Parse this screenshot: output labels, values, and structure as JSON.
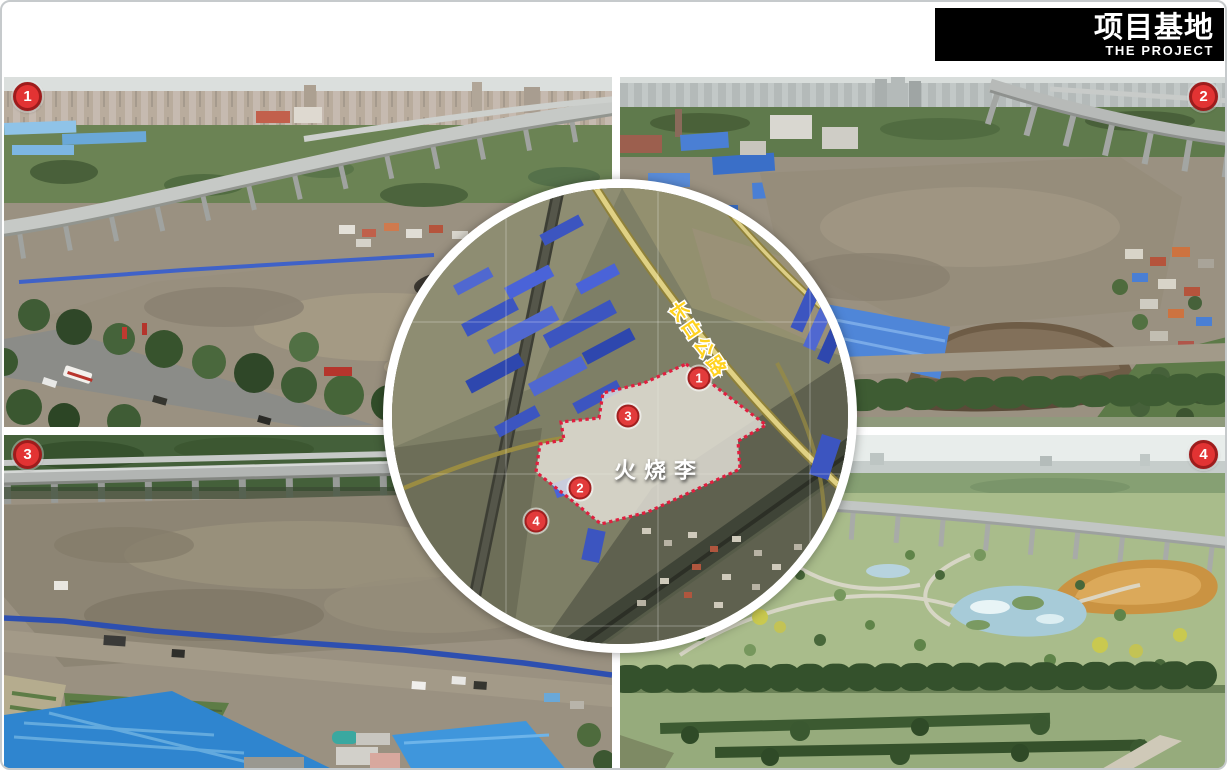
{
  "slide": {
    "title_cn": "项目基地",
    "title_en": "THE PROJECT"
  },
  "photos": [
    {
      "badge": "1",
      "position": "top-left"
    },
    {
      "badge": "2",
      "position": "top-right"
    },
    {
      "badge": "3",
      "position": "bottom-left"
    },
    {
      "badge": "4",
      "position": "bottom-right"
    }
  ],
  "map": {
    "site_label": "火烧李",
    "road_label": "长白公路",
    "site_boundary_points": "294,176 374,237 346,253 348,281 256,324 209,336 178,311 144,284 148,256 172,252 169,234 207,230 211,205 252,195",
    "markers": [
      {
        "label": "1",
        "x": 307,
        "y": 190
      },
      {
        "label": "2",
        "x": 188,
        "y": 300
      },
      {
        "label": "3",
        "x": 236,
        "y": 228
      },
      {
        "label": "4",
        "x": 144,
        "y": 333
      }
    ]
  },
  "colors": {
    "badge_red": "#e23333",
    "badge_border": "#9e1c1c",
    "boundary_red": "#e01f3f",
    "road_yellow": "#ffd21f",
    "title_bg": "#000000"
  }
}
